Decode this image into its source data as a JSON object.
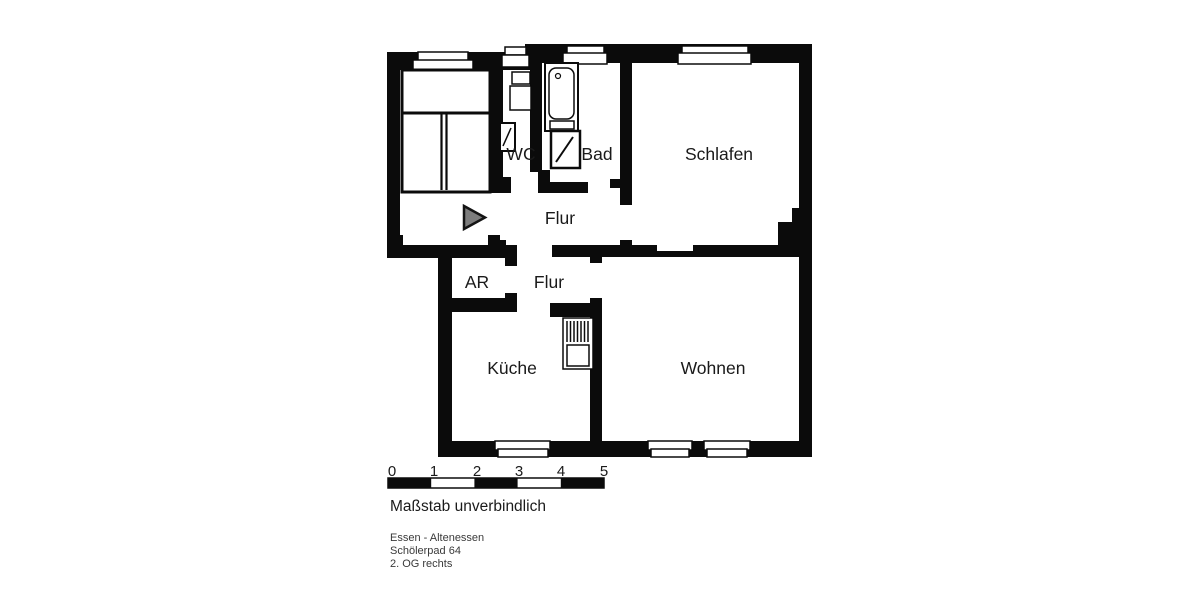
{
  "plan_title": "Wohnungsgrundriss",
  "colors": {
    "wall": "#0b0b0b",
    "background": "#ffffff",
    "arrow_fill": "#7d7d7d",
    "text": "#1a1a1a",
    "address_text": "#3a3a3a"
  },
  "rooms": {
    "wc": {
      "label": "WC"
    },
    "bad": {
      "label": "Bad"
    },
    "schlafen": {
      "label": "Schlafen"
    },
    "flur_oben": {
      "label": "Flur"
    },
    "ar": {
      "label": "AR"
    },
    "flur_unten": {
      "label": "Flur"
    },
    "kueche": {
      "label": "Küche"
    },
    "wohnen": {
      "label": "Wohnen"
    }
  },
  "scale": {
    "ticks": [
      "0",
      "1",
      "2",
      "3",
      "4",
      "5"
    ],
    "caption": "Maßstab unverbindlich"
  },
  "address": {
    "line1": "Essen - Altenessen",
    "line2": "Schölerpad 64",
    "line3": "2. OG rechts"
  }
}
